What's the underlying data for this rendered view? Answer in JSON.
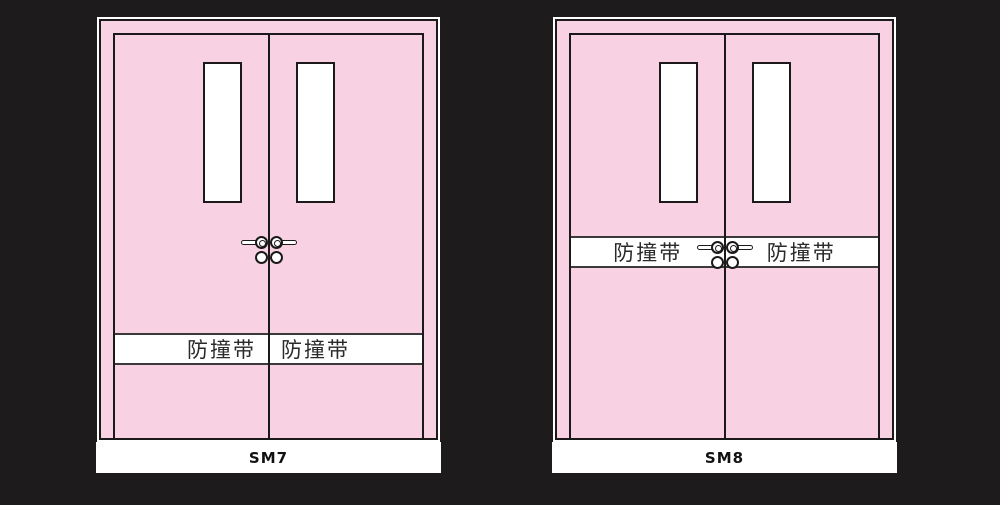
{
  "colors": {
    "background": "#1e1b1c",
    "door_pink": "#f8d2e2",
    "outline": "#1c191a",
    "band_white": "#ffffff",
    "band_border": "#3a3a3a"
  },
  "doors": [
    {
      "model": "SM7",
      "band": {
        "left_label": "防撞带",
        "right_label": "防撞带",
        "position": "lower"
      }
    },
    {
      "model": "SM8",
      "band": {
        "left_label": "防撞带",
        "right_label": "防撞带",
        "position": "middle"
      }
    }
  ]
}
